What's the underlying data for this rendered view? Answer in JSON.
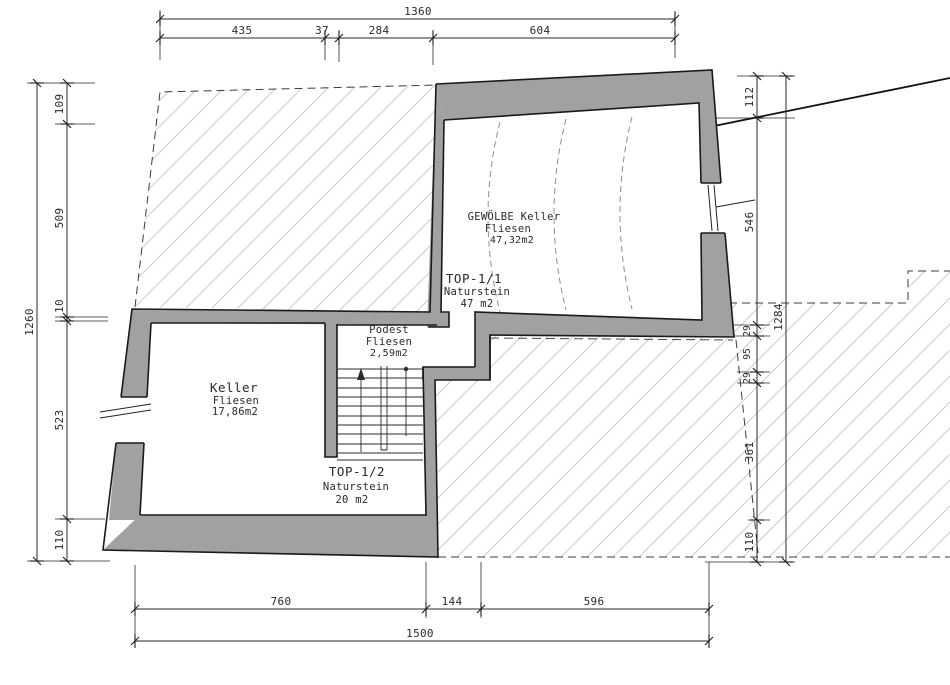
{
  "drawing_type": "basement floor plan",
  "rooms": {
    "gewoelbe": {
      "name": "GEWÖLBE Keller",
      "finish": "Fliesen",
      "area": "47,32m2"
    },
    "top11": {
      "name": "TOP-1/1",
      "finish": "Naturstein",
      "area": "47 m2"
    },
    "keller": {
      "name": "Keller",
      "finish": "Fliesen",
      "area": "17,86m2"
    },
    "podest": {
      "name": "Podest",
      "finish": "Fliesen",
      "area": "2,59m2"
    },
    "top12": {
      "name": "TOP-1/2",
      "finish": "Naturstein",
      "area": "20 m2"
    }
  },
  "dims": {
    "top": {
      "total": "1360",
      "segments": [
        "435",
        "37",
        "284",
        "604"
      ]
    },
    "left": {
      "total": "1260",
      "segments": [
        "109",
        "509",
        "10",
        "523",
        "110"
      ]
    },
    "right": {
      "total": "1284",
      "segments": [
        "112",
        "546",
        "29",
        "95",
        "29",
        "361",
        "110"
      ]
    },
    "bottom": {
      "total": "1500",
      "segments": [
        "760",
        "144",
        "596"
      ]
    }
  },
  "colors": {
    "wall": "#a1a1a1",
    "hatch": "#cccccc",
    "line": "#1a1a1a",
    "dash": "#3c3c3c"
  }
}
